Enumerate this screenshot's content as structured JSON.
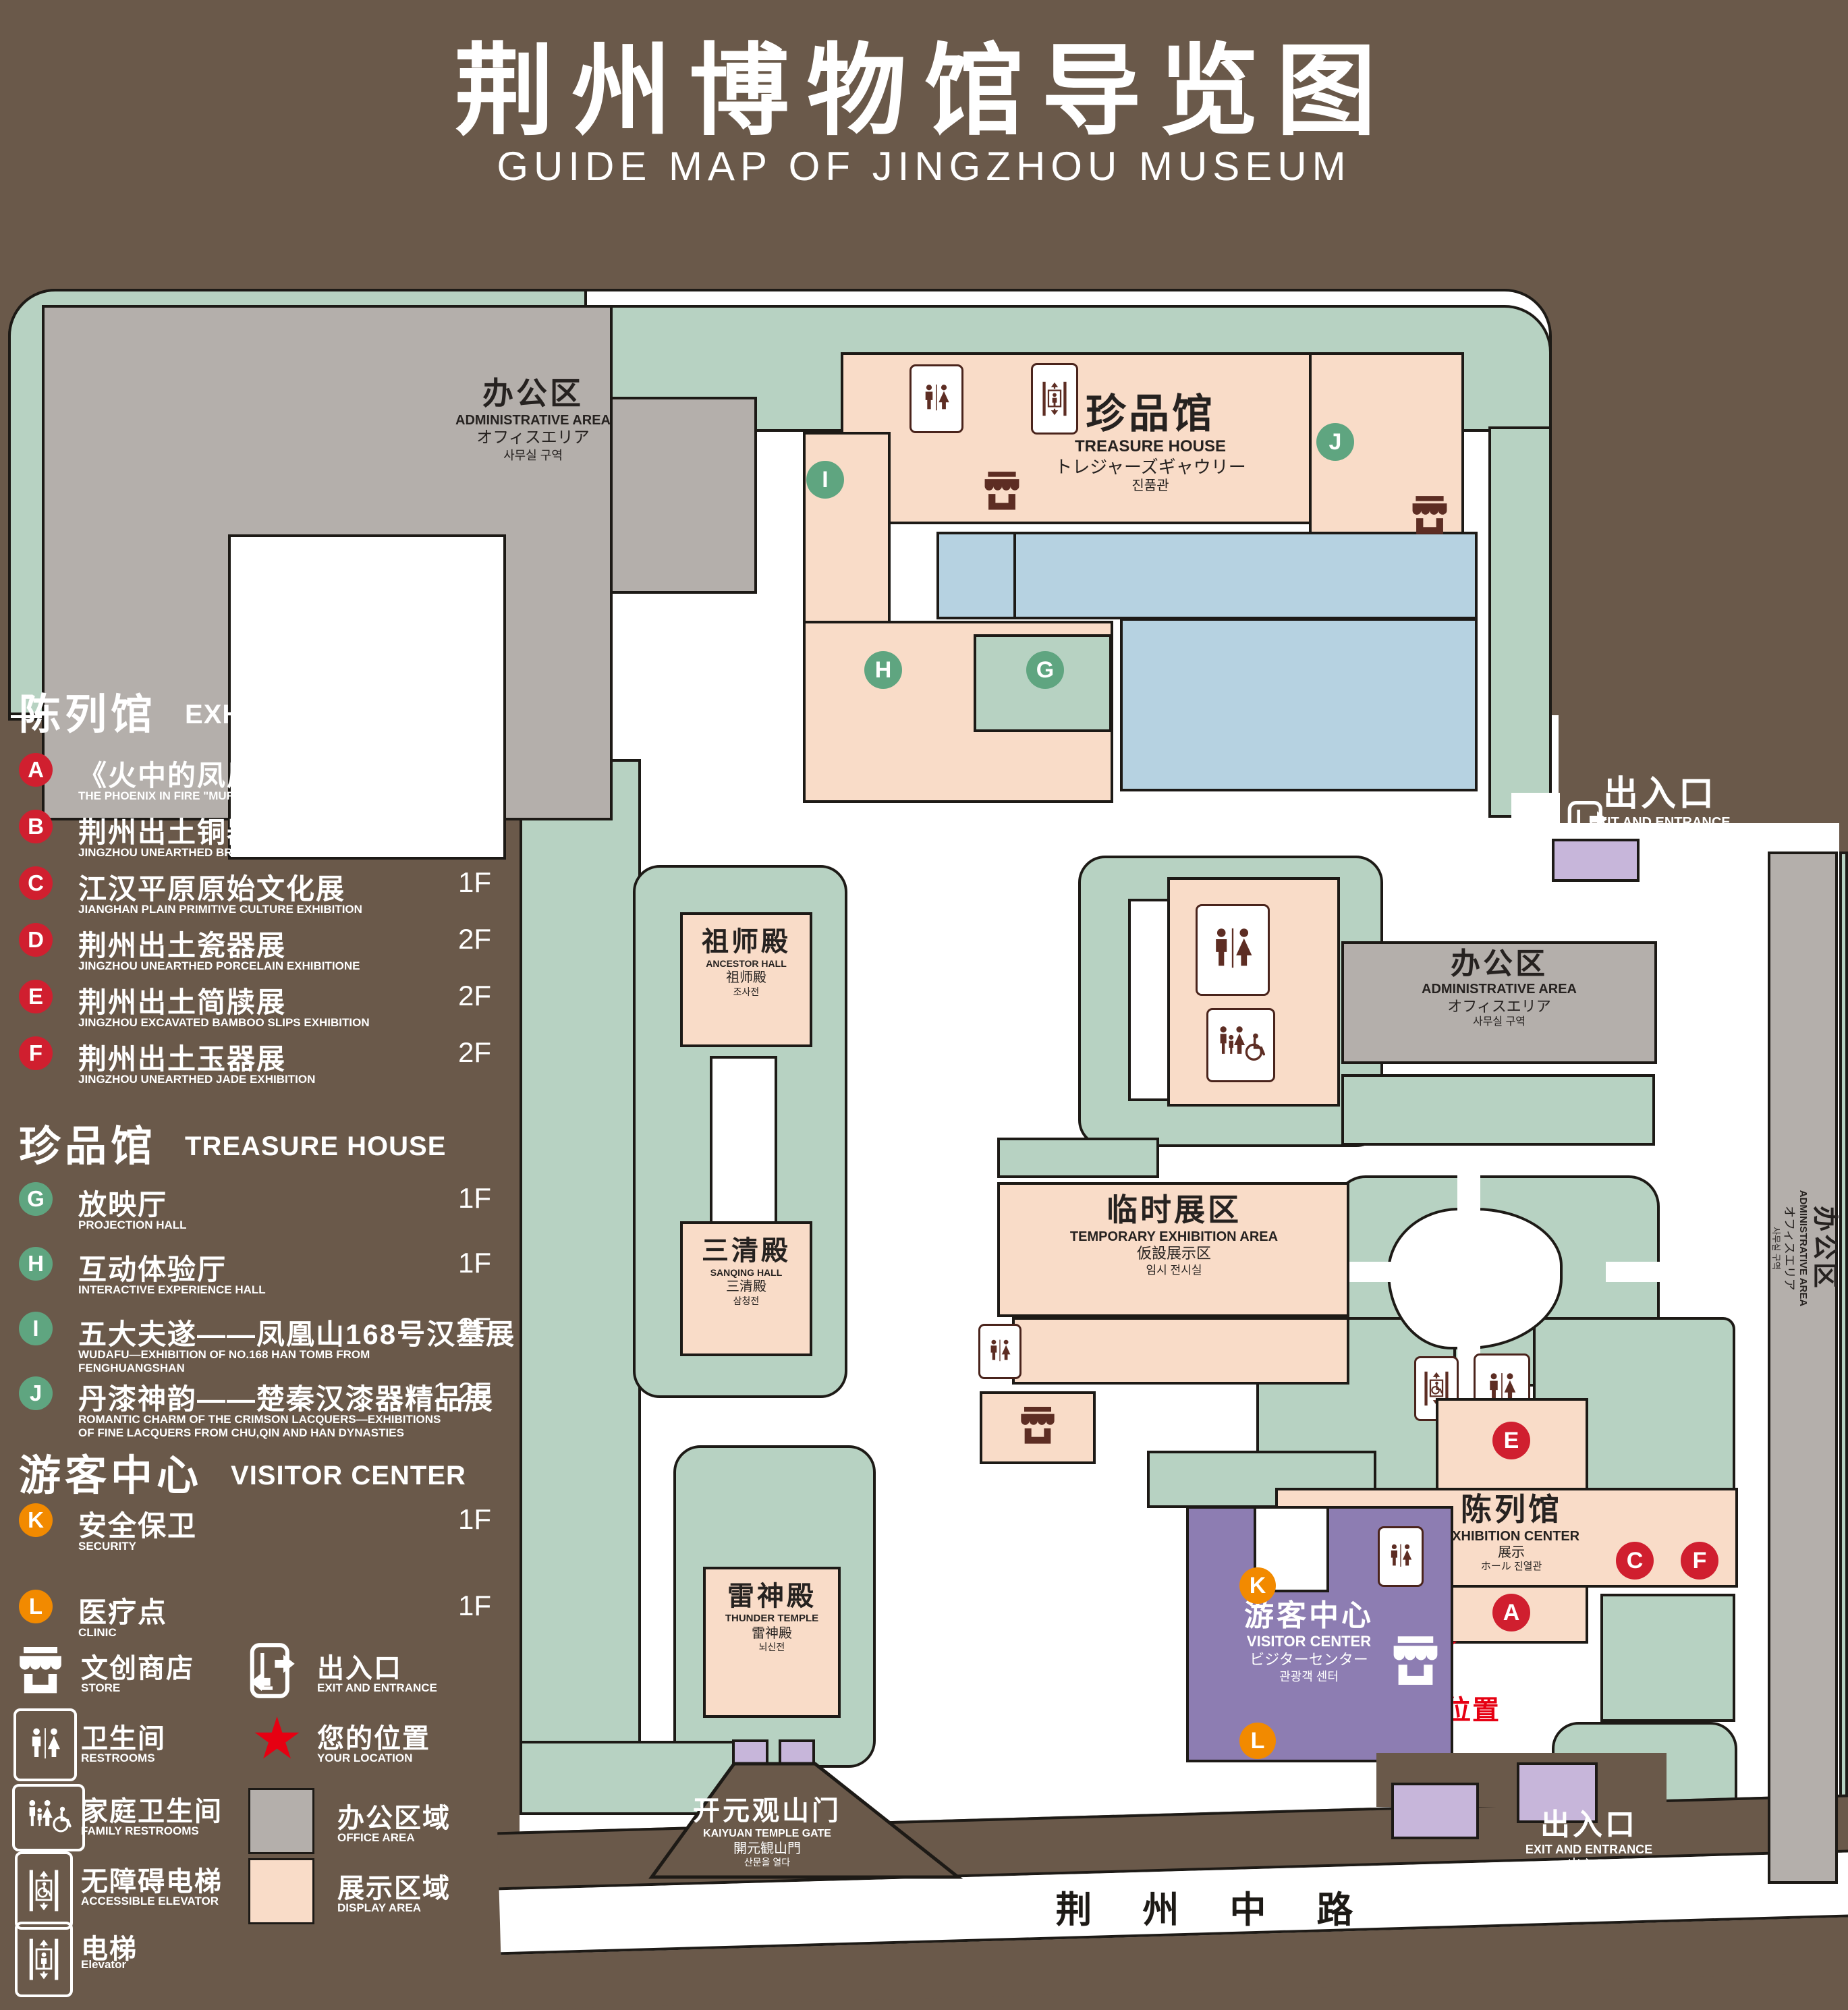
{
  "title": {
    "zh": "荆州博物馆导览图",
    "en": "GUIDE MAP OF JINGZHOU MUSEUM"
  },
  "legend": {
    "sections": [
      {
        "zh": "陈列馆",
        "en": "EXHIBITION CENTER",
        "items": [
          {
            "letter": "A",
            "zh": "《火中的凤凰》壁画",
            "en": "THE PHOENIX IN FIRE \"MURAL PAINTING",
            "floor": "1F"
          },
          {
            "letter": "B",
            "zh": "荆州出土铜器展",
            "en": "JINGZHOU UNEARTHED BRONZE WARE EXHIBITION",
            "floor": "1F"
          },
          {
            "letter": "C",
            "zh": "江汉平原原始文化展",
            "en": "JIANGHAN PLAIN PRIMITIVE CULTURE EXHIBITION",
            "floor": "1F"
          },
          {
            "letter": "D",
            "zh": "荆州出土瓷器展",
            "en": "JINGZHOU UNEARTHED PORCELAIN EXHIBITIONE",
            "floor": "2F"
          },
          {
            "letter": "E",
            "zh": "荆州出土简牍展",
            "en": "JINGZHOU EXCAVATED BAMBOO SLIPS EXHIBITION",
            "floor": "2F"
          },
          {
            "letter": "F",
            "zh": "荆州出土玉器展",
            "en": "JINGZHOU UNEARTHED JADE EXHIBITION",
            "floor": "2F"
          }
        ]
      },
      {
        "zh": "珍品馆",
        "en": "TREASURE HOUSE",
        "items": [
          {
            "letter": "G",
            "zh": "放映厅",
            "en": "PROJECTION HALL",
            "floor": "1F"
          },
          {
            "letter": "H",
            "zh": "互动体验厅",
            "en": "INTERACTIVE EXPERIENCE HALL",
            "floor": "1F"
          },
          {
            "letter": "I",
            "zh": "五大夫遂——凤凰山168号汉墓展",
            "en": "WUDAFU—EXHIBITION OF NO.168 HAN TOMB FROM FENGHUANGSHAN",
            "floor": "2F"
          },
          {
            "letter": "J",
            "zh": "丹漆神韵——楚秦汉漆器精品展",
            "en": "ROMANTIC CHARM OF THE CRIMSON LACQUERS—EXHIBITIONS OF FINE LACQUERS FROM CHU,QIN AND HAN DYNASTIES",
            "floor": "1-2F"
          }
        ]
      },
      {
        "zh": "游客中心",
        "en": "VISITOR CENTER",
        "items": [
          {
            "letter": "K",
            "zh": "安全保卫",
            "en": "SECURITY",
            "floor": "1F"
          },
          {
            "letter": "L",
            "zh": "医疗点",
            "en": "CLINIC",
            "floor": "1F"
          }
        ]
      }
    ],
    "symbols": [
      {
        "icon": "store-icon",
        "zh": "文创商店",
        "en": "STORE"
      },
      {
        "icon": "exit-entrance-icon",
        "zh": "出入口",
        "en": "EXIT AND ENTRANCE"
      },
      {
        "icon": "restrooms-icon",
        "zh": "卫生间",
        "en": "RESTROOMS"
      },
      {
        "icon": "your-location-star",
        "zh": "您的位置",
        "en": "YOUR LOCATION"
      },
      {
        "icon": "family-restrooms-icon",
        "zh": "家庭卫生间",
        "en": "FAMILY RESTROOMS"
      },
      {
        "icon": "office-area-swatch",
        "zh": "办公区域",
        "en": "OFFICE AREA",
        "color": "#b4afab"
      },
      {
        "icon": "accessible-elevator-icon",
        "zh": "无障碍电梯",
        "en": "ACCESSIBLE ELEVATOR"
      },
      {
        "icon": "display-area-swatch",
        "zh": "展示区域",
        "en": "DISPLAY AREA",
        "color": "#f9dcc8"
      },
      {
        "icon": "elevator-icon",
        "zh": "电梯",
        "en": "Elevator"
      }
    ]
  },
  "map": {
    "buildings": {
      "admin": {
        "zh": "办公区",
        "en": "ADMINISTRATIVE AREA",
        "ja": "オフィスエリア",
        "ko": "사무실 구역"
      },
      "treasure": {
        "zh": "珍品馆",
        "en": "TREASURE HOUSE",
        "ja": "トレジャーズギャウリー",
        "ko": "진품관"
      },
      "ancestor": {
        "zh": "祖师殿",
        "en": "ANCESTOR HALL",
        "ja": "祖师殿",
        "ko": "조사전"
      },
      "sanqing": {
        "zh": "三清殿",
        "en": "SANQING HALL",
        "ja": "三清殿",
        "ko": "삼청전"
      },
      "thunder": {
        "zh": "雷神殿",
        "en": "THUNDER TEMPLE",
        "ja": "雷神殿",
        "ko": "뇌신전"
      },
      "temporary": {
        "zh": "临时展区",
        "en": "TEMPORARY EXHIBITION AREA",
        "ja": "仮設展示区",
        "ko": "임시 전시실"
      },
      "exhibition": {
        "zh": "陈列馆",
        "en": "EXHIBITION CENTER",
        "ja": "展示",
        "ko": "ホール 진열관"
      },
      "visitor": {
        "zh": "游客中心",
        "en": "VISITOR CENTER",
        "ja": "ビジターセンター",
        "ko": "관광객 센터"
      },
      "gate": {
        "zh": "开元观山门",
        "en": "KAIYUAN TEMPLE GATE",
        "ja": "開元観山門",
        "ko": "산문을 열다"
      }
    },
    "exit": {
      "zh": "出入口",
      "en": "EXIT AND ENTR ANCE",
      "en_fixed": "EXIT AND ENTRANCE",
      "ja": "出入口",
      "ko": "출입구"
    },
    "road": "荆 州 中 路",
    "your_location": "您的位置",
    "colors": {
      "background": "#6a594a",
      "landscape": "#b7d2c2",
      "display_area": "#f9dcc8",
      "office_area": "#b4afab",
      "pond": "#b6d2e1",
      "visitor_center": "#8d7db2",
      "gate_purple": "#c7b6da",
      "badge_red": "#d01f2f",
      "badge_green": "#5fa580",
      "badge_orange": "#f28a00",
      "location_red": "#e60012"
    }
  }
}
